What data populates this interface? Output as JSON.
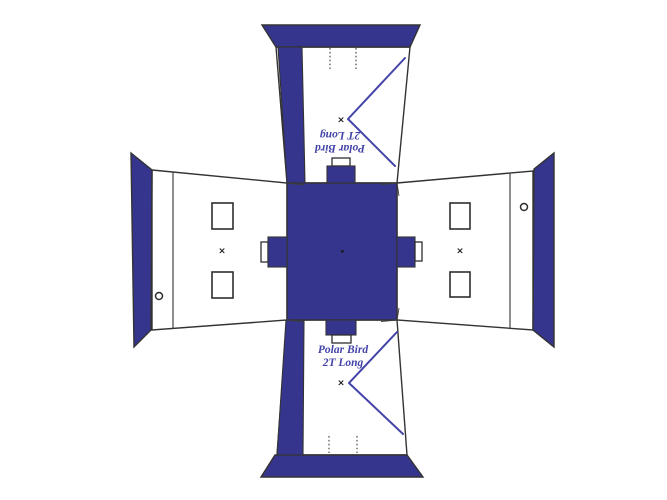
{
  "diagram": {
    "type": "tent-layout-pattern",
    "label": {
      "line1": "Polar Bird",
      "line2": "2T Long"
    },
    "marks": {
      "x_glyph": "×"
    },
    "colors": {
      "fabric": "#35358e",
      "outline": "#333333",
      "door_line": "#4343a8",
      "label_text": "#4343a8"
    }
  }
}
